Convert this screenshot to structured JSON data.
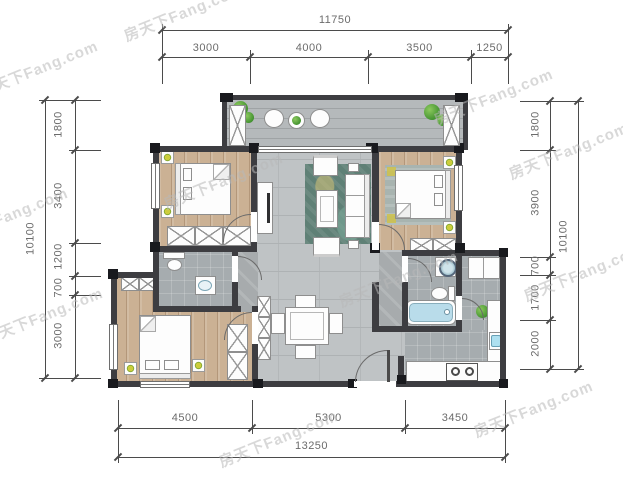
{
  "watermark": {
    "text": "房天下Fang.com"
  },
  "dims": {
    "top": {
      "total": "11750",
      "segments": [
        "3000",
        "4000",
        "3500",
        "1250"
      ]
    },
    "left": {
      "total": "10100",
      "segments": [
        "1800",
        "3400",
        "1200",
        "700",
        "3000"
      ]
    },
    "right": {
      "total": "10100",
      "segments": [
        "1800",
        "3900",
        "700",
        "1700",
        "2000"
      ]
    },
    "bottom": {
      "total": "13250",
      "segments": [
        "4500",
        "5300",
        "3450"
      ]
    }
  },
  "colors": {
    "wall": "#3d3d41",
    "column": "#191a1e",
    "wood_floor": "#cbb194",
    "tile_floor": "#bfc3c5",
    "balcony_floor": "#b5b9bb",
    "bath_floor": "#a6acaf",
    "rug_teal": "#5f8076",
    "bathtub_blue": "#b9dcea",
    "plant_green": "#55a03c",
    "accent_yellow": "#cdcd3c",
    "dim_line": "#4b4b4b",
    "dim_text": "#6b6b6b",
    "watermark_gray": "#b8b8b8"
  },
  "icons": {
    "plant-icon": "green radial circle",
    "potted-plant-icon": "yellow-green blob in white pot",
    "bed-icon": "white rect with pillows and fold",
    "wardrobe-icon": "white box with X",
    "door-arc-icon": "quarter-circle swing",
    "window-icon": "white strip with mullion line",
    "toilet-icon": "tank plus oval bowl",
    "sink-icon": "basin in white box",
    "bathtub-icon": "blue rounded tub",
    "washer-icon": "white box with drum circle",
    "stove-icon": "two burner rings",
    "fridge-icon": "white double box",
    "sofa-icon": "sectioned white rect",
    "armchair-icon": "small white seat",
    "coffee-table-icon": "white rect with inner frame",
    "dining-table-icon": "square table with four chairs",
    "tv-icon": "slim dark bar on cabinet",
    "round-table-icon": "white circle with plant"
  }
}
